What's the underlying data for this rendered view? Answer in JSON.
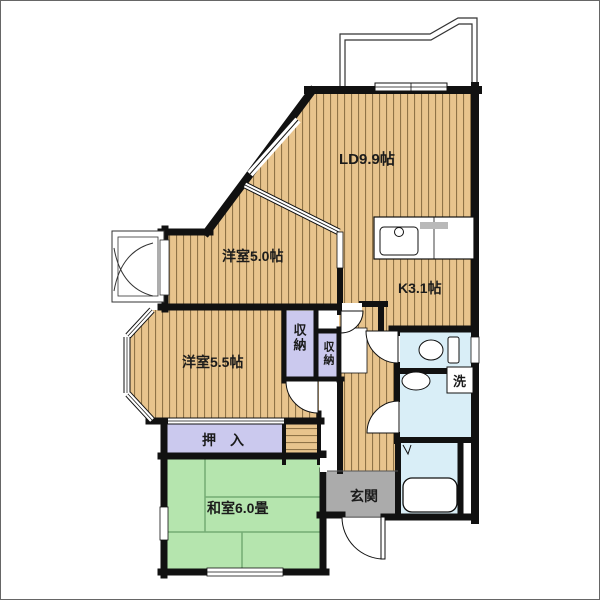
{
  "meta": {
    "type": "japanese-apartment-floor-plan"
  },
  "colors": {
    "wall": "#111111",
    "wood_base": "#e8c48d",
    "wood_stripe": "#8f7347",
    "tatami": "#b5e5ae",
    "tatami_line": "#74ab74",
    "closet": "#cbc9ee",
    "entry": "#ababab",
    "water": "#d9eef7",
    "balcony_line": "#333333",
    "counter_gray": "#b9b9b9"
  },
  "labels": {
    "living_dining": "LD9.9帖",
    "western_5_0": "洋室5.0帖",
    "kitchen": "K3.1帖",
    "western_5_5": "洋室5.5帖",
    "japanese_room": "和室6.0畳",
    "storage_a": "収納",
    "storage_b": "収納",
    "oshiire": "押　入",
    "entrance": "玄関",
    "washer": "洗"
  }
}
